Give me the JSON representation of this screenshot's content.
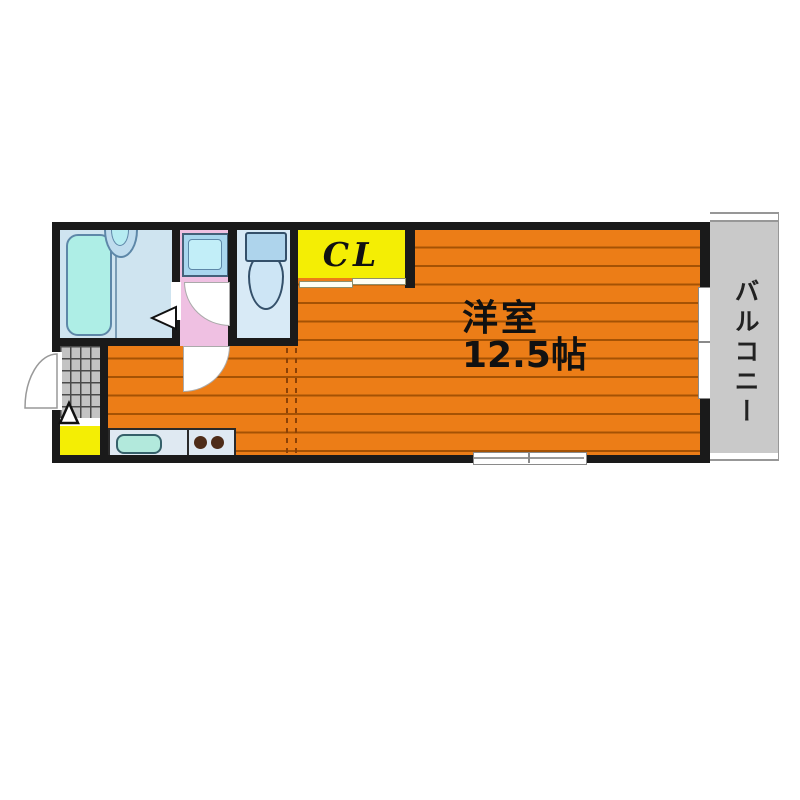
{
  "floor_plan": {
    "labels": {
      "closet": "CL",
      "room_name": "洋室",
      "room_size": "12.5帖",
      "balcony": "バルコニー"
    },
    "colors": {
      "wall": "#1a1a1a",
      "floor_orange": "#ec7d17",
      "floor_stripe": "#a55204",
      "closet_yellow": "#f4ee04",
      "shoe_cabinet_yellow": "#f4ee04",
      "bathroom_blue": "#cfe4f0",
      "bathtub_cyan": "#aeeee6",
      "washroom_pink": "#efc0e2",
      "toilet_room_blue": "#d8eaf6",
      "balcony_gray": "#c9c9c9",
      "entry_tile_gray": "#c3c3c3",
      "kitchen_counter_blue": "#dfe9f2",
      "kitchen_sink_cyan": "#b2e9dc",
      "burner_brown": "#4e2c18"
    },
    "rooms": [
      {
        "name": "bathroom",
        "fixtures": [
          "bathtub",
          "sink"
        ]
      },
      {
        "name": "washroom",
        "fixtures": [
          "washing-machine-pan"
        ]
      },
      {
        "name": "toilet-room",
        "fixtures": [
          "toilet"
        ]
      },
      {
        "name": "closet",
        "label": "CL"
      },
      {
        "name": "entry",
        "fixtures": [
          "entry-tiles",
          "shoe-cabinet",
          "entry-door"
        ]
      },
      {
        "name": "kitchen",
        "fixtures": [
          "kitchen-sink",
          "stove-burners"
        ]
      },
      {
        "name": "western-room",
        "label": "洋室 12.5帖"
      },
      {
        "name": "balcony",
        "label": "バルコニー"
      }
    ]
  }
}
